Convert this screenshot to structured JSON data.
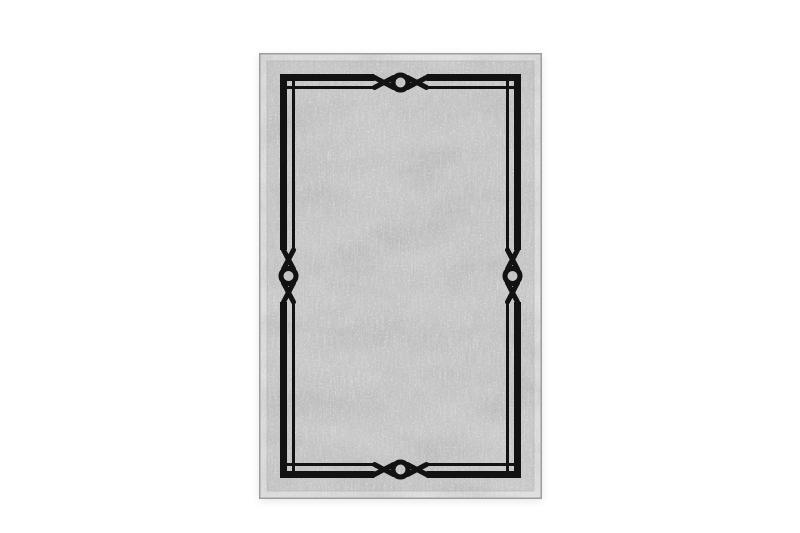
{
  "image": {
    "type": "product-photo",
    "subject": "rectangular-area-rug",
    "description": "Grey vintage distressed rectangular rug with a black double-line border frame and knot-and-ring motifs at the middle of each side",
    "background_color": "#ffffff",
    "rug": {
      "edge_band_color": "#dcdcdc",
      "edge_line_color": "#9e9e9e",
      "field_color": "#c5c5c5",
      "field_line_color": "#aeaeae",
      "frame_color": "#121212",
      "speckle_color": "#ffffff",
      "streak_color": "#f2f2f2",
      "blotch_color": "#8f8f8f",
      "motif_name": "knot-ring-motif",
      "motif_count": "4",
      "corner_gap_squares": "4"
    }
  }
}
